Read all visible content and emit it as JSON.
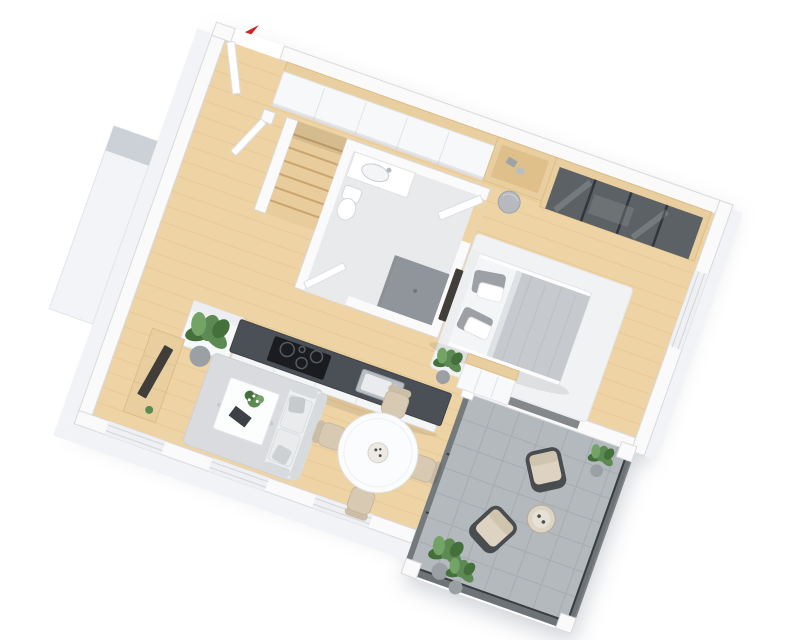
{
  "figure": {
    "type": "3d-floor-plan",
    "background": "#ffffff"
  },
  "palette": {
    "wood": "#eed3a4",
    "woodGrain": "#e0bf8c",
    "wood2": "#e9cf9f",
    "woodEdge": "#dcbd85",
    "wall": "#fafafb",
    "wallOutline": "#d9dade",
    "exterior": "#f2f3f6",
    "blockTop": "#ccd1d7",
    "bathFloor": "#e9eaec",
    "shower": "#8f959b",
    "counter": "#4b5056",
    "cooktop": "#1b1c1f",
    "steel": "#b9bec3",
    "glass": "#5c6165",
    "glassFrame": "#3a3d40",
    "rugBed": "#f1f2f4",
    "rugLiving": "#dadbde",
    "sofa": "#eef0f1",
    "sofaShade": "#d8dbde",
    "blanket": "#c6c9cd",
    "pillowGray": "#9da1a6",
    "beige": "#d8cab2",
    "beigeDark": "#cbbda6",
    "outdoorCushion": "#ddd3c0",
    "outdoorFrame": "#4a4d50",
    "balconyFloor": "#b4b9be",
    "balconyLine": "#a6abb0",
    "plant": "#5d8a52",
    "plantDark": "#44703c",
    "plantLight": "#74a465",
    "pot": "#9ba0a4",
    "tv": "#413e3a",
    "arrow": "#cf2020",
    "stairWood": "#e8cc9b",
    "stairLine": "#c9a56f",
    "shadow": "#9aa0ab"
  },
  "scene": {
    "north_arrow": {
      "icon": "entrance-arrow-icon",
      "color": "#cf2020"
    },
    "rooms": [
      "entrance-hall",
      "staircase-nook",
      "bathroom",
      "bedroom",
      "kitchen",
      "living-room",
      "dining-area",
      "balcony"
    ],
    "furniture": [
      "entrance-door",
      "hall-wardrobe",
      "desk-niche",
      "pouf",
      "glass-front-closet",
      "double-bed",
      "bedroom-rug",
      "dresser",
      "kitchen-island",
      "cooktop",
      "kitchen-sink",
      "tall-cabinet",
      "tv-sideboard",
      "tv",
      "sofa",
      "coffee-table",
      "living-rug",
      "round-dining-table",
      "dining-chairs",
      "bathroom-vanity",
      "washbasin",
      "toilet",
      "shower",
      "lounge-chairs",
      "balcony-side-table",
      "glass-balustrade",
      "potted-plants"
    ]
  }
}
